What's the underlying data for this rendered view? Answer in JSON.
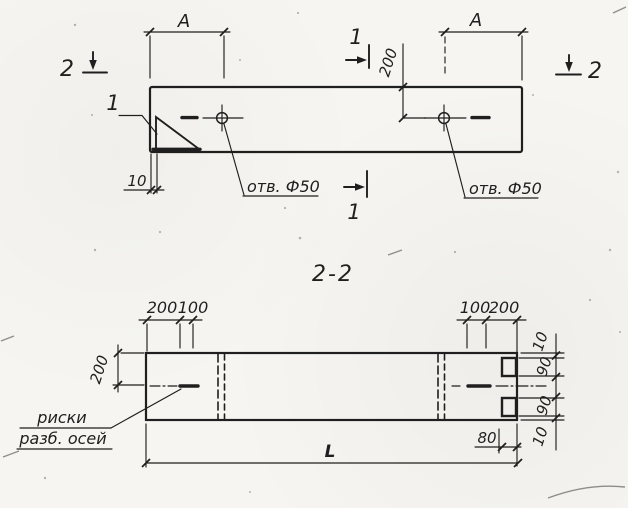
{
  "colors": {
    "paper": "#f6f5f1",
    "ink": "#1f1f1f"
  },
  "top_view": {
    "dim_a_left": "А",
    "dim_a_right": "А",
    "dim_200": "200",
    "dim_10": "10",
    "hole_label_left": "отв. Ф50",
    "hole_label_right": "отв. Ф50",
    "detail_mark": "1",
    "section_mark_1_top": "1",
    "section_mark_1_bottom": "1",
    "section_mark_2_left": "2",
    "section_mark_2_right": "2"
  },
  "section_view": {
    "title": "2-2",
    "top_left_dims": [
      "200",
      "100"
    ],
    "top_right_dims": [
      "100",
      "200"
    ],
    "left_dim": "200",
    "right_stack_dims": [
      "10",
      "90",
      "90",
      "10"
    ],
    "bottom_dim_80": "80",
    "length_dim": "L",
    "axis_marks_label_line1": "риски",
    "axis_marks_label_line2": "разб. осей"
  }
}
